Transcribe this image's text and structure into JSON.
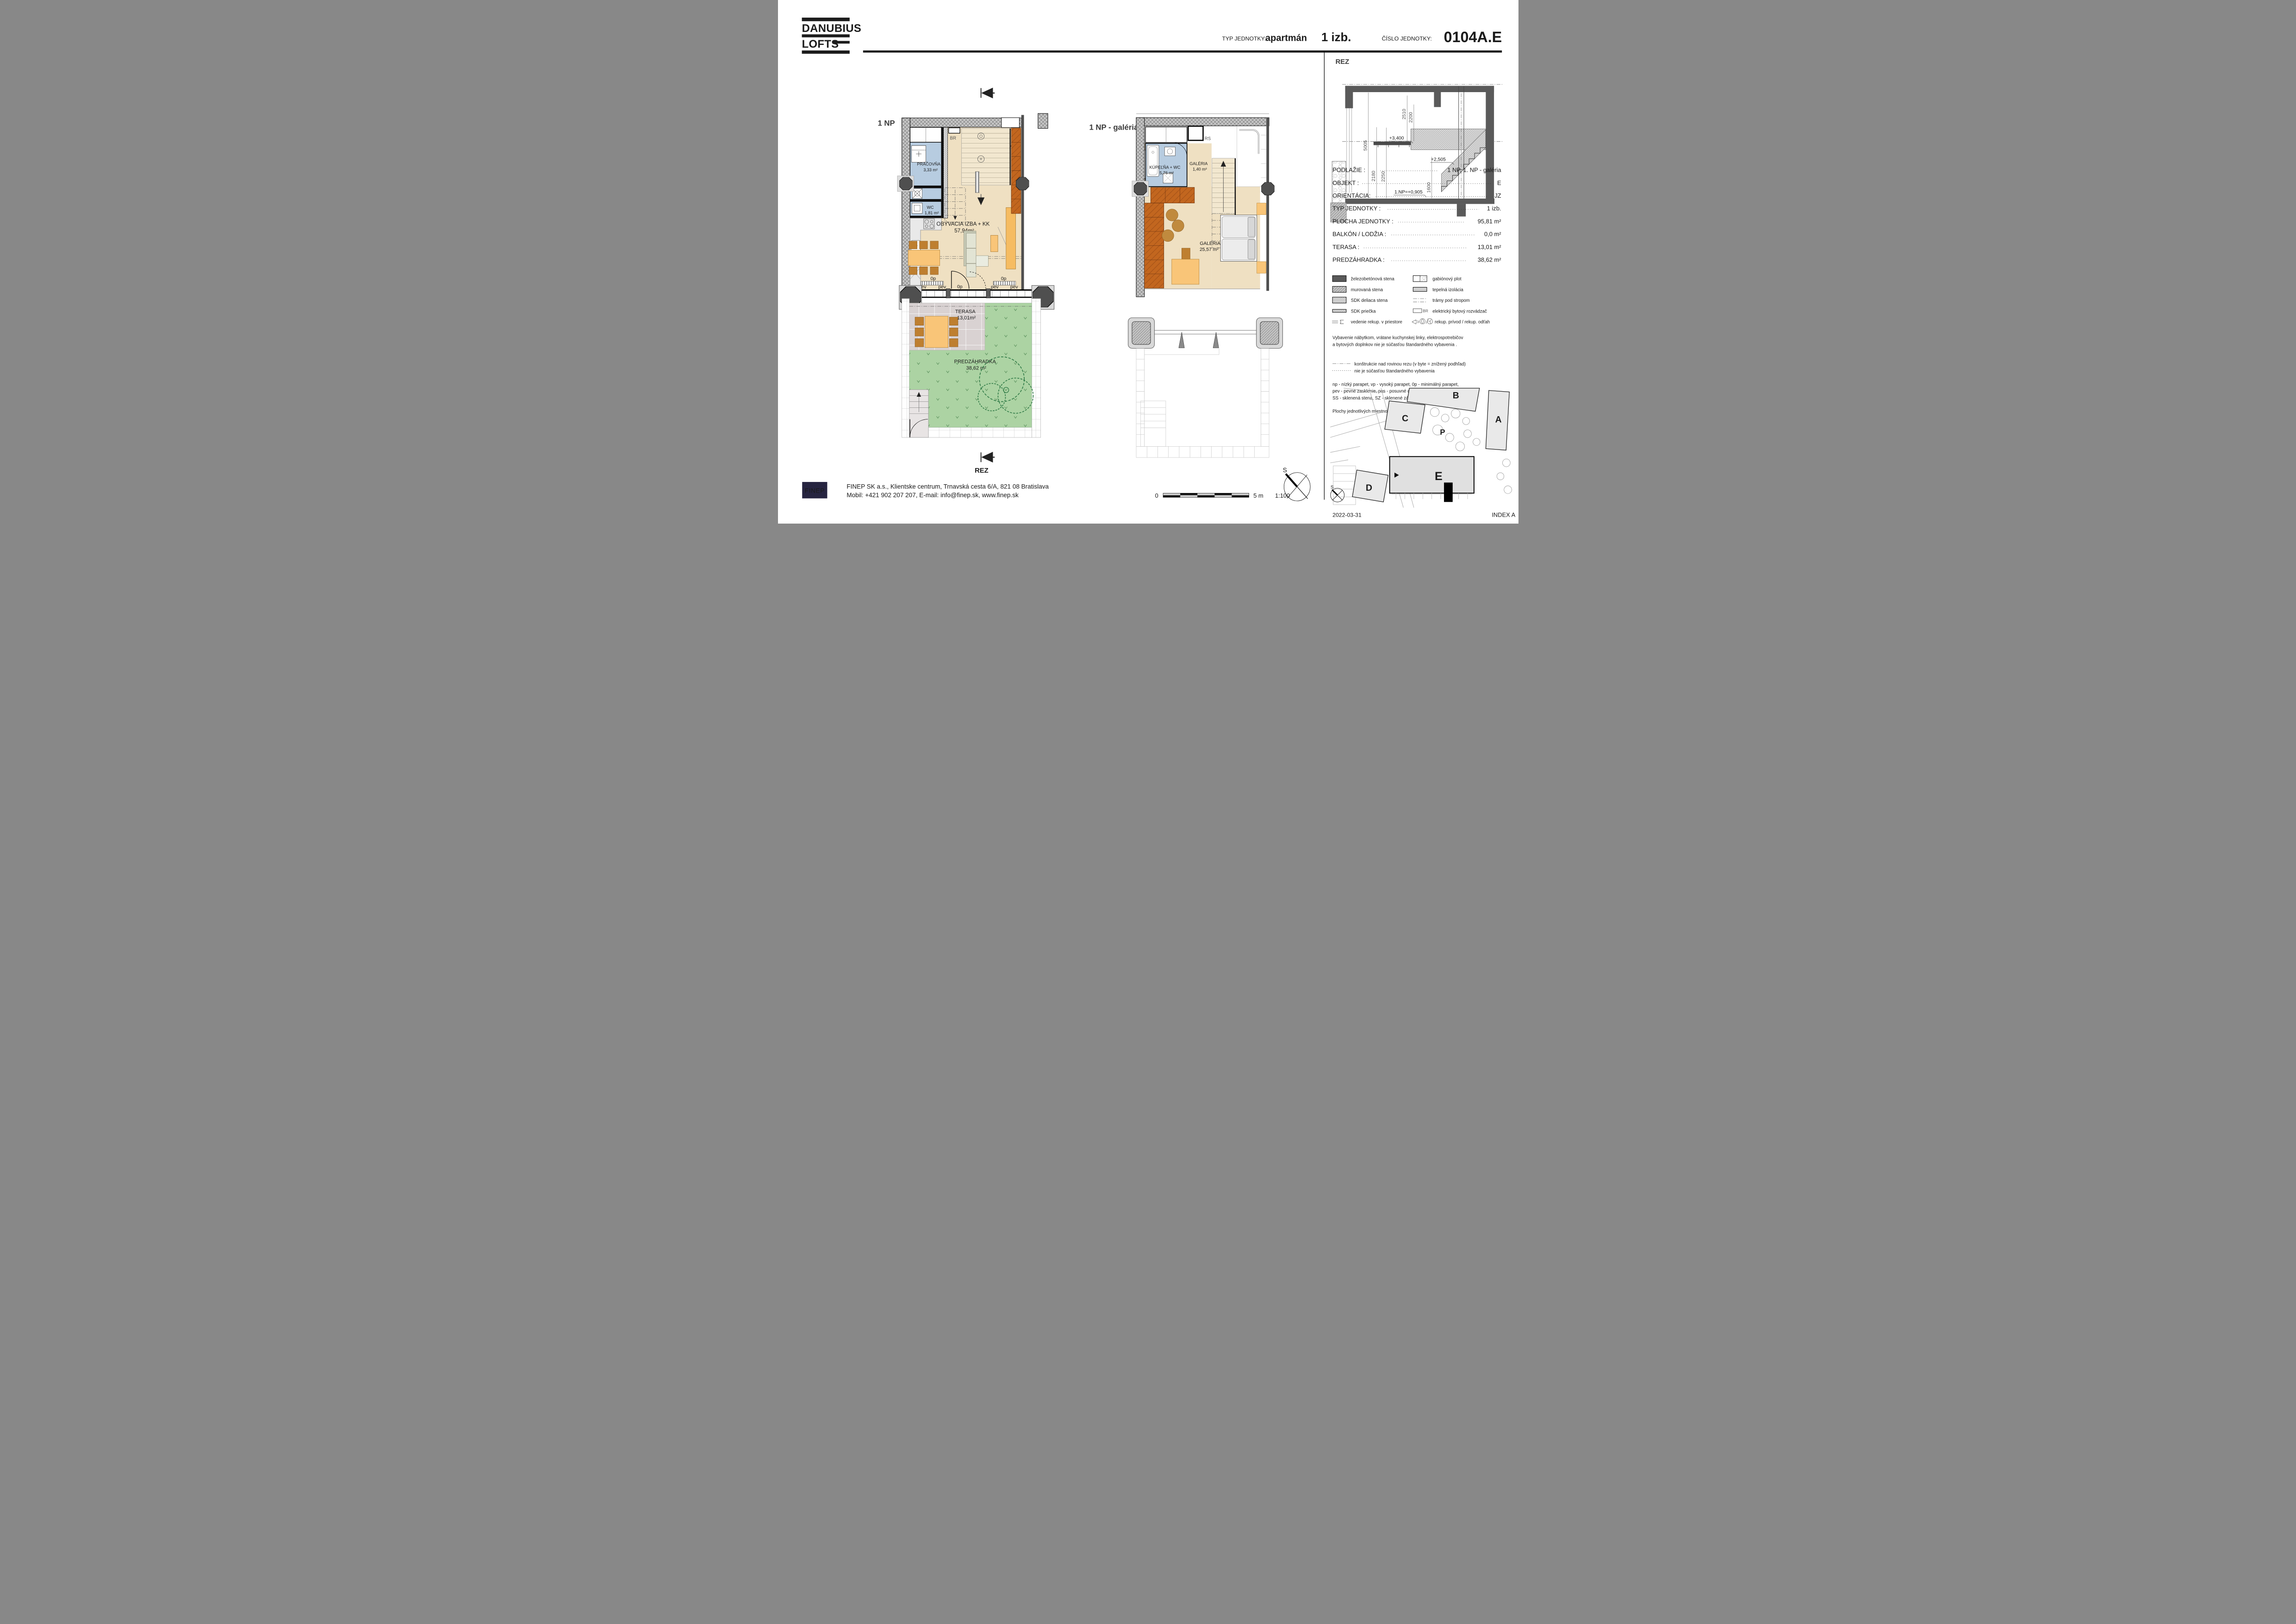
{
  "header": {
    "brand1": "DANUBIUS",
    "brand2": "LOFTS",
    "type_label": "TYP JEDNOTKY:",
    "type_value": "apartmán",
    "type_size": "1 izb.",
    "number_label": "ČÍSLO JEDNOTKY:",
    "number_value": "0104A.E"
  },
  "plan_1np": {
    "title": "1 NP",
    "rez": "REZ",
    "br": "BR",
    "pracovna": "PRÁČOVŇA",
    "pracovna_area": "3,33 m²",
    "wc": "WC",
    "wc_area": "1,81 m²",
    "living": "OBÝVACIA IZBA + KK",
    "living_area": "57,94m²",
    "lbl_0p": "0p",
    "lbl_pev": "pev",
    "terasa": "TERASA",
    "terasa_area": "13,01m²",
    "garden": "PREDZÁHRADKA",
    "garden_area": "38,62 m²"
  },
  "plan_gallery": {
    "title": "1 NP - galéria",
    "bath": "KÚPEĽŇA + WC",
    "bath_area": "5,76 m²",
    "gal_small": "GALÉRIA",
    "gal_small_area": "1,40 m²",
    "rs": "RS",
    "gal": "GALÉRIA",
    "gal_area": "25,57 m²"
  },
  "section": {
    "title": "REZ",
    "dims": {
      "v2510": "2510",
      "v2200": "2200",
      "v5005": "5005",
      "v2180": "2180",
      "v2250": "2250",
      "v1600": "1600"
    },
    "levels": {
      "gallery": "+3,400",
      "mid": "+2,505",
      "ground": "1.NP=+0,905"
    }
  },
  "info_table": {
    "rows": [
      {
        "label": "PODLAŽIE :",
        "value": "1 NP, 1. NP - galéria"
      },
      {
        "label": "OBJEKT :",
        "value": "E"
      },
      {
        "label": "ORIENTÁCIA:",
        "value": "JZ"
      },
      {
        "label": "TYP JEDNOTKY :",
        "value": "1 izb."
      },
      {
        "label": "PLOCHA JEDNOTKY :",
        "value": "95,81 m²"
      },
      {
        "label": "BALKÓN / LODŽIA :",
        "value": "0,0 m²"
      },
      {
        "label": "TERASA :",
        "value": "13,01 m²"
      },
      {
        "label": "PREDZÁHRADKA :",
        "value": "38,62 m²"
      }
    ]
  },
  "legend": {
    "left": [
      {
        "label": "železobetónová stena"
      },
      {
        "label": "murovaná stena"
      },
      {
        "label": "SDK deliaca stena"
      },
      {
        "label": "SDK priečka"
      },
      {
        "label": "vedenie rekup. v priestore"
      }
    ],
    "right": [
      {
        "label": "gabiónový plot"
      },
      {
        "label": "tepelná izolácia"
      },
      {
        "label": "trámy pod stropom"
      },
      {
        "label": "elektrický bytový rozvádzač"
      },
      {
        "label": "rekup. prívod / rekup. odťah"
      }
    ],
    "br_tag": "BR"
  },
  "notes": {
    "equipment_1": "Vybavenie nábytkom, vrátane kuchynskej linky, elektrospotrebičov",
    "equipment_2": "a  bytových doplnkov nie je súčasťou štandardného vybavenia .",
    "legend_dashdot": "konštrukcie nad rovinou rezu (v byte = znížený podhľad)",
    "legend_dotted": "nie je súčasťou štandardného vybavenia",
    "abbr_1": "np - nízký parapet, vp - vysoký parapet, 0p - minimálný parapet,",
    "abbr_2": "pev - pevné zasklenie, pos - posuvné dvere,",
    "abbr_3": "SS - sklenená stena,  SZ - sklenené zábradlie, RS - rekuperačná skriňa",
    "areas_note": "Plochy jednotlivých miestností sú orientačné"
  },
  "siteplan": {
    "a": "A",
    "b": "B",
    "c": "C",
    "d": "D",
    "e": "E",
    "p": "P",
    "s": "S",
    "date": "2022-03-31",
    "index": "INDEX A"
  },
  "scalebar": {
    "start": "0",
    "end": "5 m",
    "ratio": "1:100"
  },
  "footer": {
    "logo": "FINEP",
    "line1": "FINEP SK a.s., Klientske centrum, Trnavská cesta 6/A, 821 08 Bratislava",
    "line2": "Mobil: +421 902 207 207, E-mail: info@finep.sk,  www.finep.sk"
  }
}
